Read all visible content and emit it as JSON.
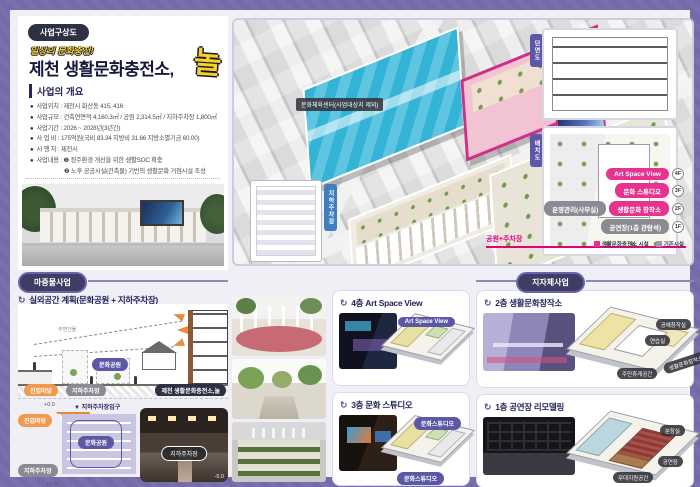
{
  "colors": {
    "frame": "#7a70ad",
    "magenta": "#e5338f",
    "navy": "#23255c",
    "purple": "#5d58a6",
    "orange": "#ef9a4e",
    "yellow": "#f7d21e"
  },
  "header": {
    "badge": "사업구상도",
    "slogan": "일상의 문화충전!",
    "title": "제천 생활문화충전소,",
    "title_accent": "놀"
  },
  "overview": {
    "heading": "사업의 개요",
    "items": [
      {
        "text": "사업위치 : 제천시 화산동 415, 416"
      },
      {
        "text": "사업규모 : 건축연면적 4,160.3㎡ / 공원 2,314.5㎡ / 지하주차장 1,800㎡"
      },
      {
        "text": "사업기간 : 2026 ~ 2028년(3년간)"
      },
      {
        "text": "사 업 비 : 175억원(국비 83.34 지방비 31.66 지방소멸기금 60.00)"
      },
      {
        "text": "시 행 자 : 제천시"
      },
      {
        "text": "사업내용 : ❶ 정주환경 개선을 위한 생활SOC 확충",
        "text2": "❷ 노후 공공시설(건축물) 기반의 생활문화 거점시설 조성"
      }
    ]
  },
  "render": {
    "site_label": "문화체육센터(사업대상지 제외)",
    "park_label": "문화공원",
    "parking_label": "지하주차장",
    "plan_tab": "지하주차장",
    "section_tab": "단면도",
    "siteplan_tab": "배치도",
    "park_line_label": "공원+주차장",
    "floors": [
      {
        "tag1": "Art Space View",
        "floor": "4F"
      },
      {
        "tag1": "문화 스튜디오",
        "floor": "3F"
      },
      {
        "tag0": "운영관리(사무실)",
        "tag1": "생활문화 창작소",
        "floor": "2F"
      },
      {
        "tag1": "공연장(1층 관람석)",
        "floor": "1F"
      }
    ],
    "legend": [
      {
        "label": "생활문화충전소 시설"
      },
      {
        "label": "기존시설"
      }
    ]
  },
  "priming": {
    "badge": "마중물사업",
    "section_title": "실외공간 계획(문화공원 + 지하주차장)",
    "diagram1": {
      "note": "주변건물",
      "park_oval": "문화공원",
      "entry": "진입마당",
      "parking": "지하주차장",
      "station": "제천 생활문화충전소,놀"
    },
    "diagram2": {
      "level_top": "+0.0",
      "entrance": "▼ 지하주차장입구",
      "park_oval": "문화공원",
      "entry": "진입마당",
      "parking": "지하주차장",
      "level_bottom": "+0.0",
      "photo_label": "지하주차장",
      "photo_level": "-5.0"
    },
    "cards": [
      {
        "title": "4층 Art Space View",
        "plan_label": "Art Space View"
      },
      {
        "title": "3층 문화 스튜디오",
        "plan_label": "문화스튜디오",
        "plan_label2": "문화스튜디오"
      }
    ]
  },
  "municipal": {
    "badge": "지자체사업",
    "cards": [
      {
        "title": "2층 생활문화창작소",
        "labels": {
          "a": "공예창작실",
          "b": "연습실",
          "c": "생활문화창작소",
          "d": "주민휴게공간"
        }
      },
      {
        "title": "1층 공연장 리모델링",
        "labels": {
          "a": "분장실",
          "b": "공연장",
          "c": "무대지원공간"
        }
      }
    ]
  }
}
